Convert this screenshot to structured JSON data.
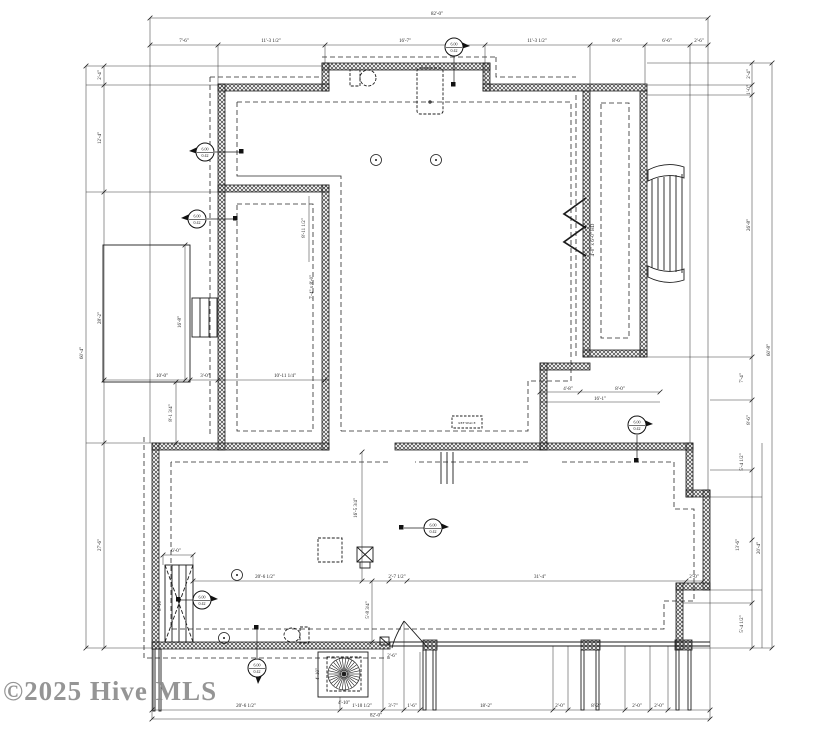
{
  "watermark": {
    "text": "©2025 Hive MLS"
  },
  "callout_marker": {
    "line1": "6.00",
    "line2": "0.42"
  },
  "appliance_label": "REF SPACE",
  "colors": {
    "line": "#1c1c1c",
    "wall_hatch": "#3f3f3f",
    "watermark": "#8a8a8a",
    "background": "#ffffff"
  },
  "dim_labels": [
    {
      "x": 437,
      "y": 15,
      "r": 0,
      "t": "82'-0\""
    },
    {
      "x": 184,
      "y": 42,
      "r": 0,
      "t": "7'-6\""
    },
    {
      "x": 271,
      "y": 42,
      "r": 0,
      "t": "11'-3 1/2\""
    },
    {
      "x": 405,
      "y": 42,
      "r": 0,
      "t": "16'-7\""
    },
    {
      "x": 537,
      "y": 42,
      "r": 0,
      "t": "11'-3 1/2\""
    },
    {
      "x": 617,
      "y": 42,
      "r": 0,
      "t": "8'-6\""
    },
    {
      "x": 667,
      "y": 42,
      "r": 0,
      "t": "6'-6\""
    },
    {
      "x": 699,
      "y": 42,
      "r": 0,
      "t": "2'-6\""
    },
    {
      "x": 246,
      "y": 707,
      "r": 0,
      "t": "20'-6 1/2\""
    },
    {
      "x": 362,
      "y": 707,
      "r": 0,
      "t": "1'-10 1/2\""
    },
    {
      "x": 393,
      "y": 707,
      "r": 0,
      "t": "3'-7\""
    },
    {
      "x": 412,
      "y": 707,
      "r": 0,
      "t": "1'-6\""
    },
    {
      "x": 486,
      "y": 707,
      "r": 0,
      "t": "18'-2\""
    },
    {
      "x": 560,
      "y": 707,
      "r": 0,
      "t": "2'-0\""
    },
    {
      "x": 596,
      "y": 707,
      "r": 0,
      "t": "8'-2\""
    },
    {
      "x": 637,
      "y": 707,
      "r": 0,
      "t": "2'-0\""
    },
    {
      "x": 659,
      "y": 707,
      "r": 0,
      "t": "2'-0\""
    },
    {
      "x": 376,
      "y": 716.5,
      "r": 0,
      "t": "82'-0\""
    },
    {
      "x": 101,
      "y": 75,
      "r": -90,
      "t": "2'-4\""
    },
    {
      "x": 101,
      "y": 138,
      "r": -90,
      "t": "12'-4\""
    },
    {
      "x": 101,
      "y": 318,
      "r": -90,
      "t": "28'-2\""
    },
    {
      "x": 101,
      "y": 545,
      "r": -90,
      "t": "27'-6\""
    },
    {
      "x": 83,
      "y": 353,
      "r": -90,
      "t": "60'-4\""
    },
    {
      "x": 750,
      "y": 74,
      "r": -90,
      "t": "2'-4\""
    },
    {
      "x": 750,
      "y": 90,
      "r": -90,
      "t": "1'-0\""
    },
    {
      "x": 750,
      "y": 225,
      "r": -90,
      "t": "26'-8\""
    },
    {
      "x": 743,
      "y": 378,
      "r": -90,
      "t": "7'-4\""
    },
    {
      "x": 750,
      "y": 420,
      "r": -90,
      "t": "8'-6\""
    },
    {
      "x": 743,
      "y": 462,
      "r": -90,
      "t": "5'-4 1/2\""
    },
    {
      "x": 739,
      "y": 545,
      "r": -90,
      "t": "13'-6\""
    },
    {
      "x": 743,
      "y": 624,
      "r": -90,
      "t": "5'-4 1/2\""
    },
    {
      "x": 770,
      "y": 350,
      "r": -90,
      "t": "60'-8\""
    },
    {
      "x": 760,
      "y": 548,
      "r": -90,
      "t": "20'-4\""
    },
    {
      "x": 162,
      "y": 377,
      "r": 0,
      "t": "10'-0\""
    },
    {
      "x": 205,
      "y": 377,
      "r": 0,
      "t": "3'-0\""
    },
    {
      "x": 285,
      "y": 377,
      "r": 0,
      "t": "10'-11 1/4\""
    },
    {
      "x": 181,
      "y": 322,
      "r": -90,
      "t": "16'-8\""
    },
    {
      "x": 305,
      "y": 228,
      "r": -90,
      "t": "8'-11 1/2\""
    },
    {
      "x": 313,
      "y": 287,
      "r": -90,
      "t": "7'-4\" x 8'-0\""
    },
    {
      "x": 594,
      "y": 240,
      "r": -90,
      "t": "4'-0\" x 6'-0\" HD"
    },
    {
      "x": 568,
      "y": 390,
      "r": 0,
      "t": "4'-8\""
    },
    {
      "x": 620,
      "y": 390,
      "r": 0,
      "t": "8'-0\""
    },
    {
      "x": 600,
      "y": 400,
      "r": 0,
      "t": "16'-1\""
    },
    {
      "x": 265,
      "y": 578,
      "r": 0,
      "t": "20'-6 1/2\""
    },
    {
      "x": 397,
      "y": 578,
      "r": 0,
      "t": "2'-7 1/2\""
    },
    {
      "x": 540,
      "y": 578,
      "r": 0,
      "t": "31'-4\""
    },
    {
      "x": 694,
      "y": 578,
      "r": 0,
      "t": "2'-0\""
    },
    {
      "x": 176,
      "y": 552,
      "r": 0,
      "t": "6'-0\""
    },
    {
      "x": 357,
      "y": 508,
      "r": -90,
      "t": "16'-5 3/4\""
    },
    {
      "x": 172,
      "y": 413,
      "r": -90,
      "t": "8'-1 3/4\""
    },
    {
      "x": 161,
      "y": 605,
      "r": -90,
      "t": "8'-10\""
    },
    {
      "x": 369,
      "y": 610,
      "r": -90,
      "t": "5'-8 3/4\""
    },
    {
      "x": 344,
      "y": 704,
      "r": 0,
      "t": "4'-10\""
    },
    {
      "x": 319,
      "y": 674,
      "r": -90,
      "t": "4'-10\""
    },
    {
      "x": 392,
      "y": 657,
      "r": 0,
      "t": "2'-6\""
    }
  ],
  "markers": [
    {
      "x": 454,
      "y": 47,
      "dir": "right"
    },
    {
      "x": 205,
      "y": 152,
      "dir": "left"
    },
    {
      "x": 197,
      "y": 219,
      "dir": "left"
    },
    {
      "x": 637,
      "y": 425,
      "dir": "right"
    },
    {
      "x": 433,
      "y": 528,
      "dir": "right"
    },
    {
      "x": 202,
      "y": 600,
      "dir": "right"
    },
    {
      "x": 257,
      "y": 668,
      "dir": "down"
    }
  ],
  "lights": [
    [
      376,
      160
    ],
    [
      436,
      160
    ],
    [
      237,
      575
    ],
    [
      224,
      638
    ]
  ]
}
